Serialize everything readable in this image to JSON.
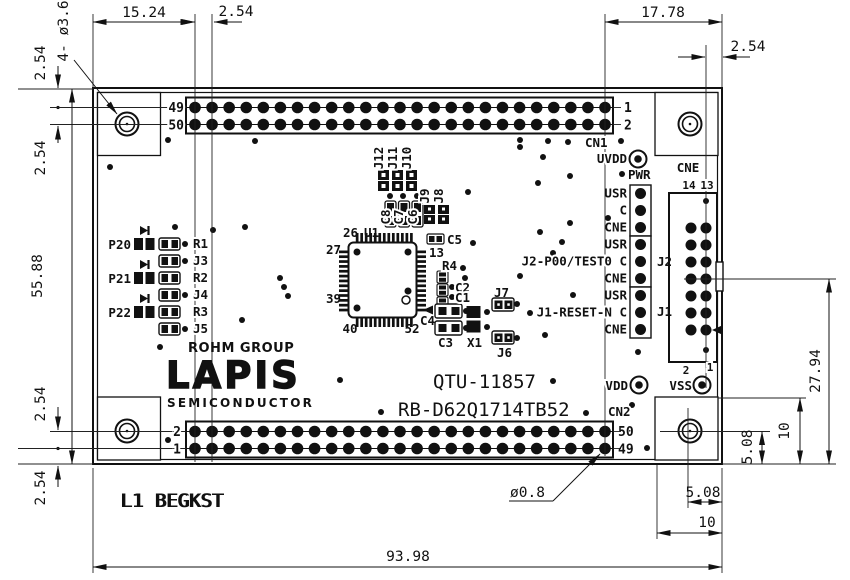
{
  "dims": {
    "top_left_width": "15.24",
    "top_pitch": "2.54",
    "top_right_width": "17.78",
    "top_right_edge": "2.54",
    "left_top_a": "2.54",
    "left_top_b": "2.54",
    "board_height": "55.88",
    "left_bottom_a": "2.54",
    "left_bottom_b": "2.54",
    "board_width": "93.98",
    "br_horiz_small": "5.08",
    "br_horiz_big": "10",
    "br_vert_small": "5.08",
    "br_vert_big": "10",
    "right_height": "27.94",
    "mount_hole_note": "4- ø3.6",
    "pin_hole_dia": "ø0.8"
  },
  "cn1": {
    "name": "CN1",
    "pin_top_left": "49",
    "pin_bottom_left": "50",
    "pin_top_right": "1",
    "pin_bottom_right": "2"
  },
  "cn2": {
    "name": "CN2",
    "pin_top_left": "2",
    "pin_bottom_left": "1",
    "pin_top_right": "50",
    "pin_bottom_right": "49"
  },
  "cne": {
    "name": "CNE",
    "col_left": "14",
    "col_right": "13",
    "bottom_left": "2",
    "bottom_right": "1"
  },
  "testpoints": {
    "uvdd": "UVDD",
    "pwr": "PWR",
    "vdd": "VDD",
    "vss": "VSS"
  },
  "jumper_column": {
    "rows": [
      "USR",
      "C",
      "CNE",
      "USR",
      "J2-P00/TEST0 C",
      "CNE",
      "USR",
      "J1-RESET-N C",
      "CNE"
    ],
    "j2": "J2",
    "j1": "J1"
  },
  "leds": [
    "P20",
    "P21",
    "P22"
  ],
  "left_components": [
    "R1",
    "J3",
    "R2",
    "J4",
    "R3",
    "J5"
  ],
  "center": {
    "top_jumpers": [
      "J12",
      "J11",
      "J10"
    ],
    "top_caps": [
      "C8",
      "C7",
      "C6"
    ],
    "mid_jumpers": [
      "J9",
      "J8"
    ],
    "u1": "U1",
    "pin26": "26",
    "pin27": "27",
    "pin39": "39",
    "pin40": "40",
    "pin52": "52",
    "c5": "C5",
    "c5_pin": "13",
    "r4": "R4",
    "c2": "C2",
    "c1": "C1",
    "c4": "C4",
    "c3": "C3",
    "x1": "X1",
    "j7": "J7",
    "j6": "J6"
  },
  "branding": {
    "rohm": "ROHM GROUP",
    "lapis": "LAPIS",
    "semi": "SEMICONDUCTOR"
  },
  "ident": {
    "board_no": "QTU-11857",
    "part_no": "RB-D62Q1714TB52"
  },
  "silk": {
    "bottom_left": "L1 BEGKST"
  }
}
